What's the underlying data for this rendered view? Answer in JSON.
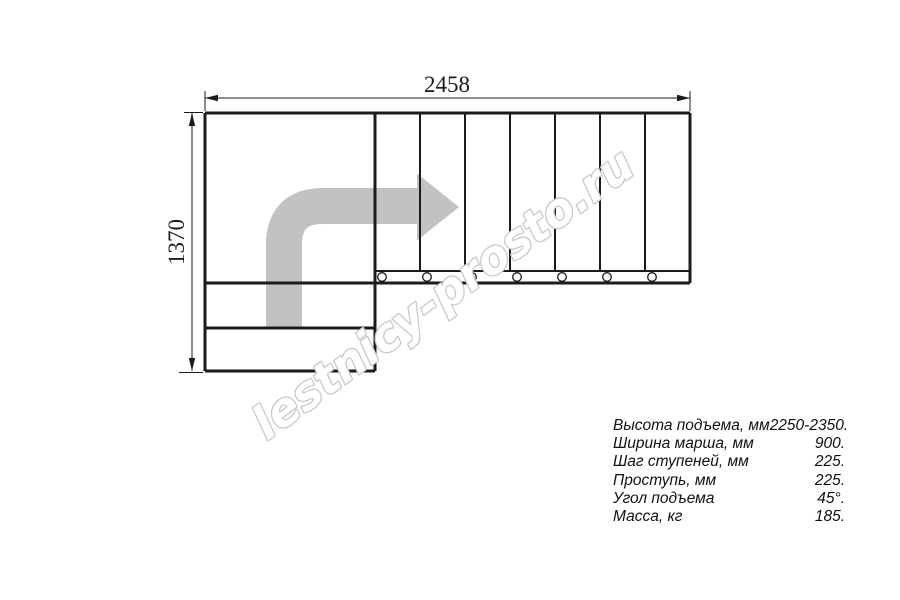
{
  "drawing": {
    "width_label": "2458",
    "height_label": "1370",
    "arrow_icon": "right-turn-direction-arrow"
  },
  "watermark": {
    "text": "lestnicy-prosto.ru"
  },
  "specs": {
    "rows": [
      {
        "label": "Высота подъема, мм",
        "value": "2250-2350."
      },
      {
        "label": "Ширина марша, мм",
        "value": "900."
      },
      {
        "label": "Шаг ступеней, мм",
        "value": "225."
      },
      {
        "label": "Проступь, мм",
        "value": "225."
      },
      {
        "label": "Угол подъема",
        "value": "45°."
      },
      {
        "label": "Масса, кг",
        "value": "185."
      }
    ]
  },
  "colors": {
    "line": "#1b1b1b",
    "arrow_fill": "#c2c2c2",
    "watermark_stroke": "#c9c9c9",
    "watermark_fill": "#ffffff",
    "background": "#ffffff"
  }
}
